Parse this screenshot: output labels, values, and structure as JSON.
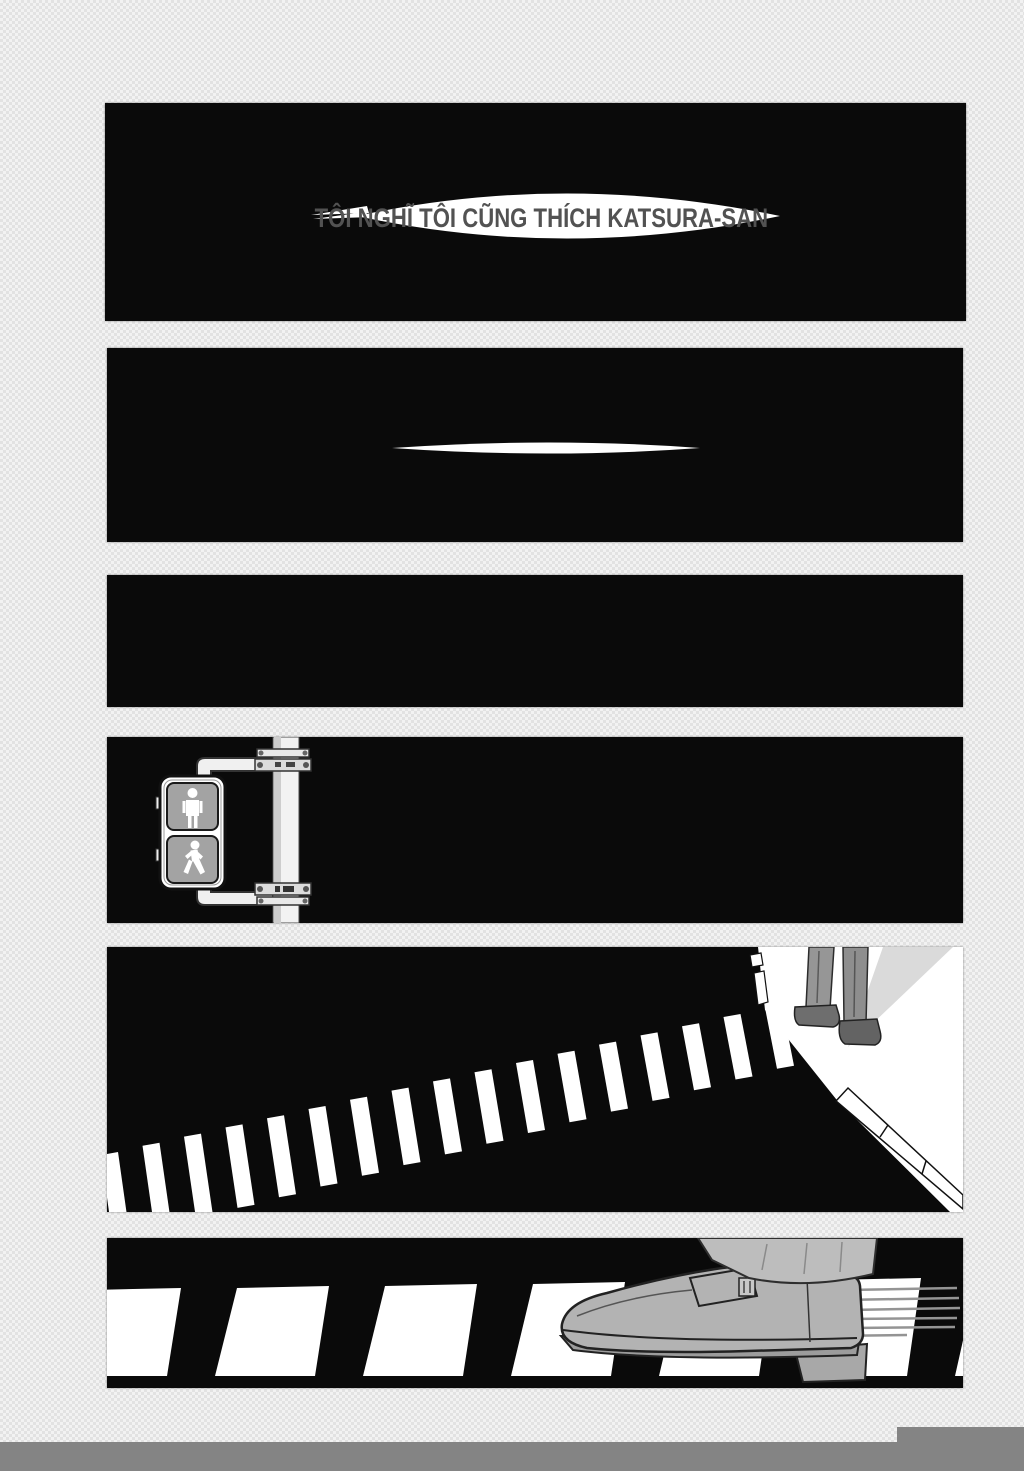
{
  "dialogue": {
    "panel1": "TÔI NGHĨ TÔI CŨNG THÍCH KATSURA-SAN"
  },
  "colors": {
    "page_background": "#f2f2f2",
    "page_checker": "#e2e2e2",
    "panel_black": "#0a0a0a",
    "speech_bubble": "#ffffff",
    "dialogue_text": "#525252",
    "footer_bar": "#848484",
    "crosswalk_stripe": "#ffffff",
    "signal_lens": "#a3a3a3",
    "trouser_gray": "#969696",
    "shoe_gray": "#b3b3b3"
  },
  "icons": {
    "pedestrian_signal": "pedestrian-signal-icon",
    "stand_figure": "standing-person-icon",
    "walk_figure": "walking-person-icon"
  }
}
